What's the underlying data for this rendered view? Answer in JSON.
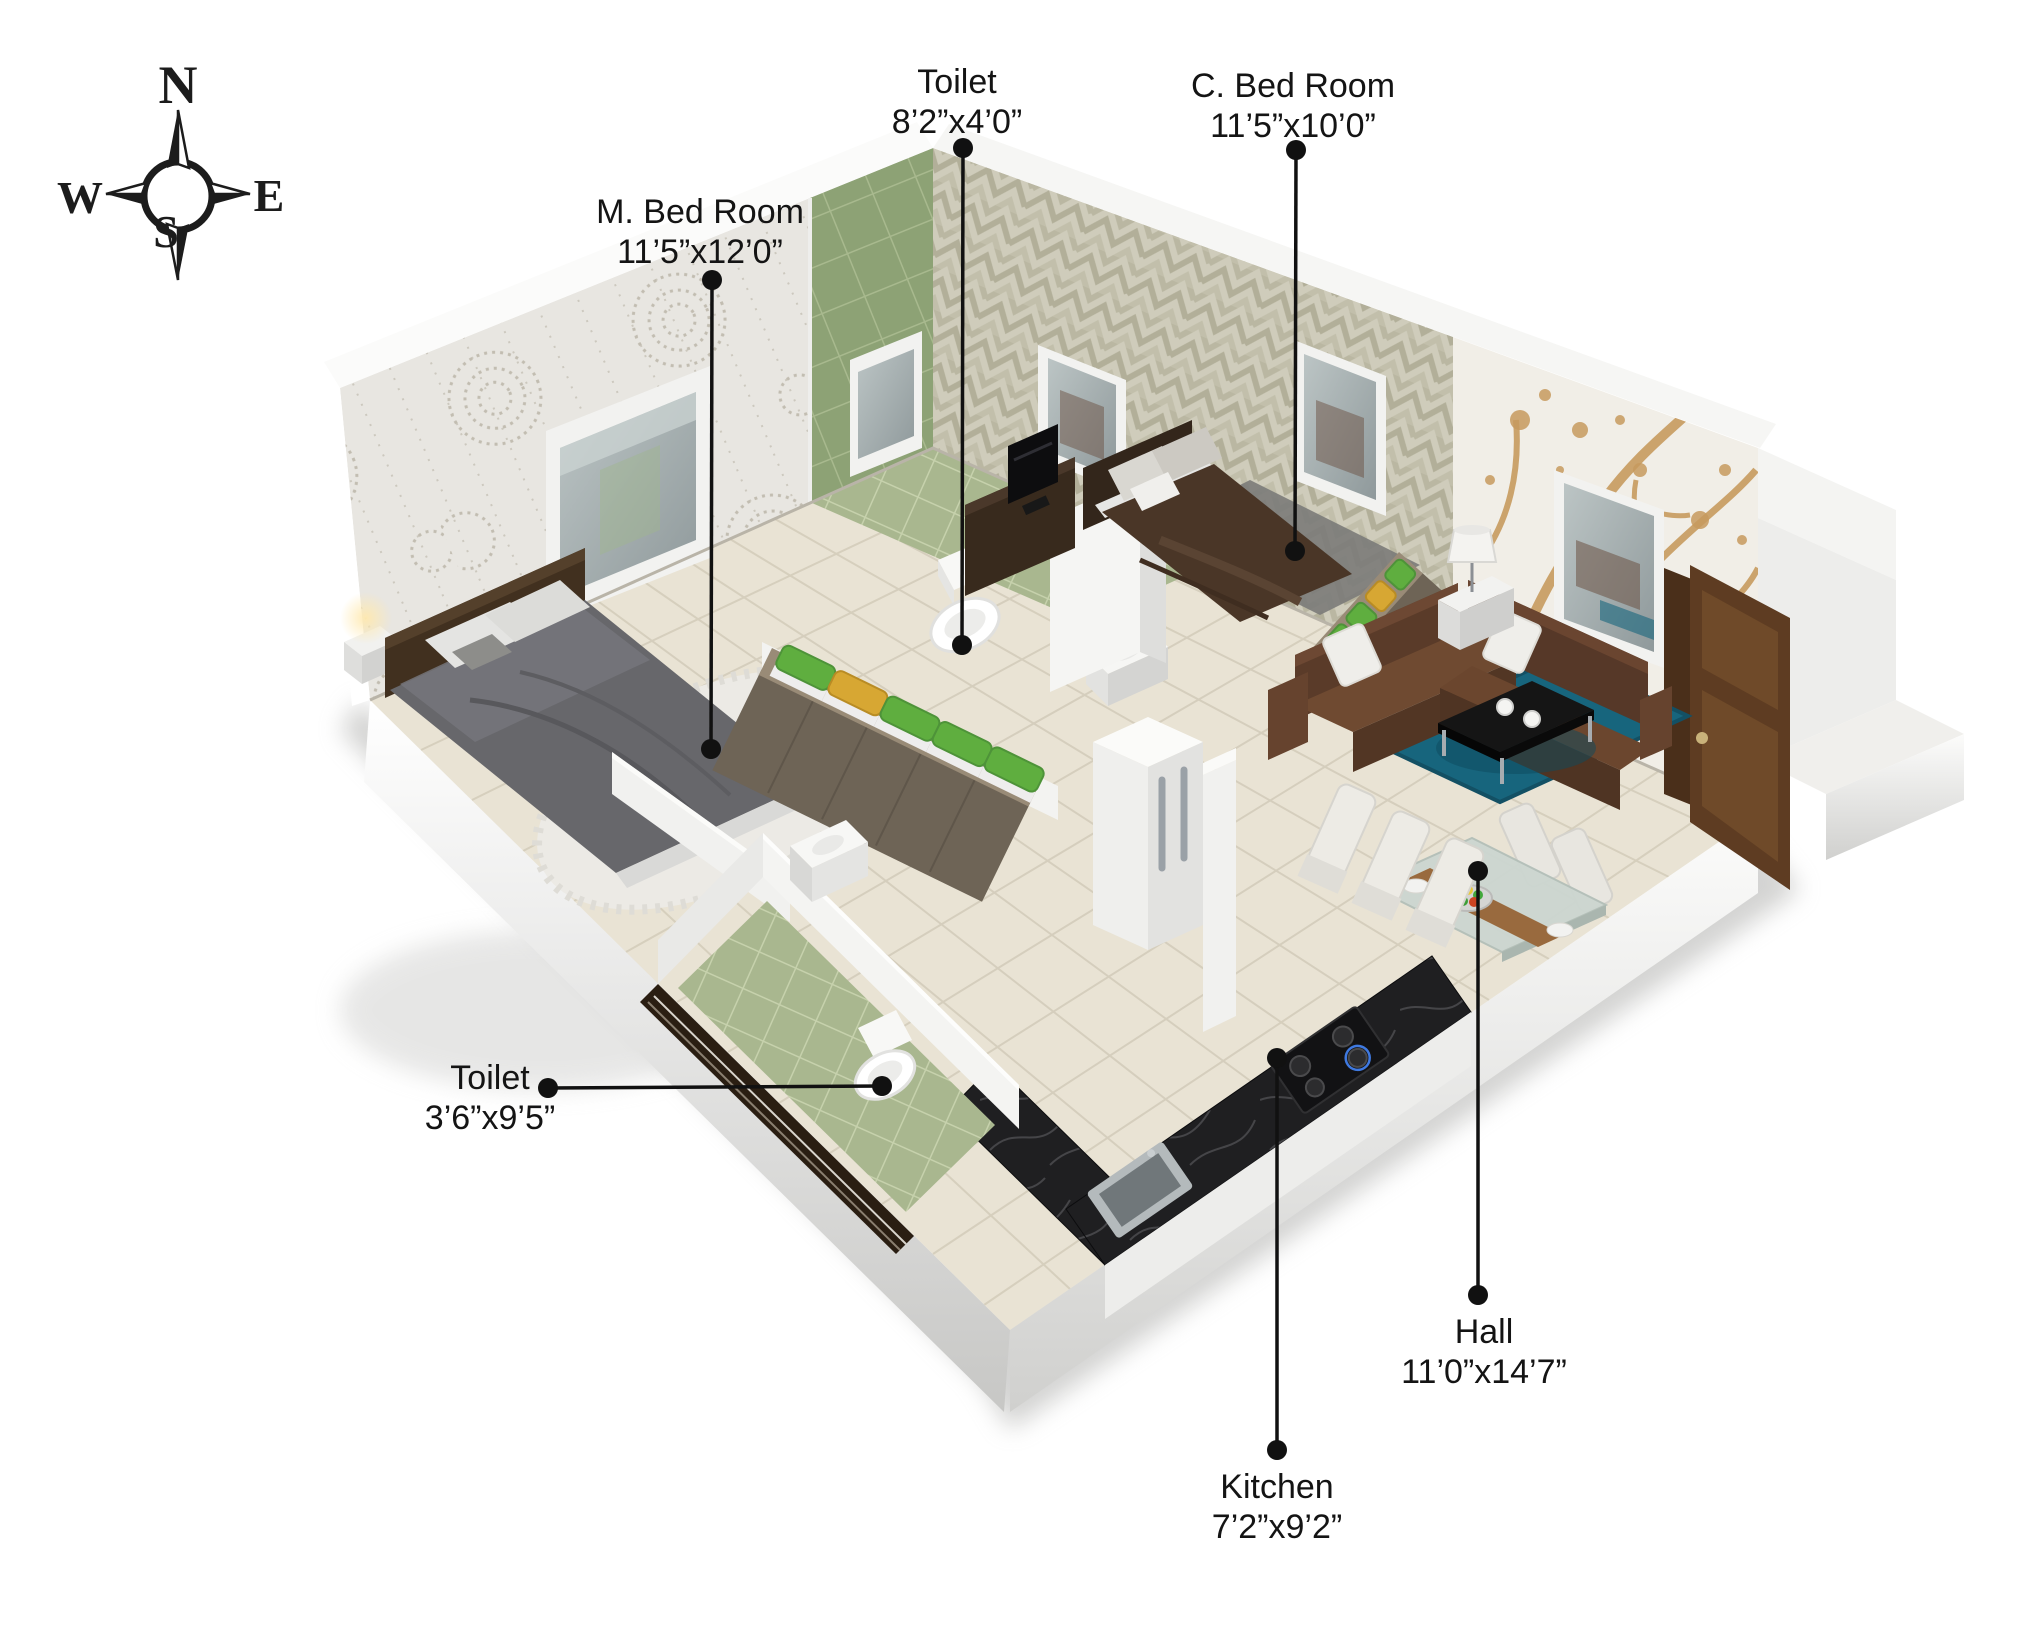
{
  "compass": {
    "north": "N",
    "south": "S",
    "east": "E",
    "west": "W"
  },
  "rooms": {
    "toilet_top": {
      "name": "Toilet",
      "dims": "8’2”x4’0”"
    },
    "c_bed_room": {
      "name": "C. Bed Room",
      "dims": "11’5”x10’0”"
    },
    "m_bed_room": {
      "name": "M. Bed Room",
      "dims": "11’5”x12’0”"
    },
    "toilet_left": {
      "name": "Toilet",
      "dims": "3’6”x9’5”"
    },
    "hall": {
      "name": "Hall",
      "dims": "11’0”x14’7”"
    },
    "kitchen": {
      "name": "Kitchen",
      "dims": "7’2”x9’2”"
    }
  },
  "colors": {
    "label_ink": "#141414",
    "floor_cream": "#e9e3d4",
    "toilet_tile_green": "#8da275",
    "toilet_floor_green": "#a9b78f",
    "herringbone_beige": "#d8d5c3",
    "branch_tan": "#c79a5e",
    "rug_teal": "#17657d",
    "sofa_brown": "#6f4a31",
    "c_bed_brown": "#4a3627",
    "m_bed_gray": "#67676b",
    "towel_green": "#5fae3f",
    "towel_yellow": "#d7a733",
    "counter_black": "#1f1f21",
    "wood_shelf": "#998b77"
  }
}
